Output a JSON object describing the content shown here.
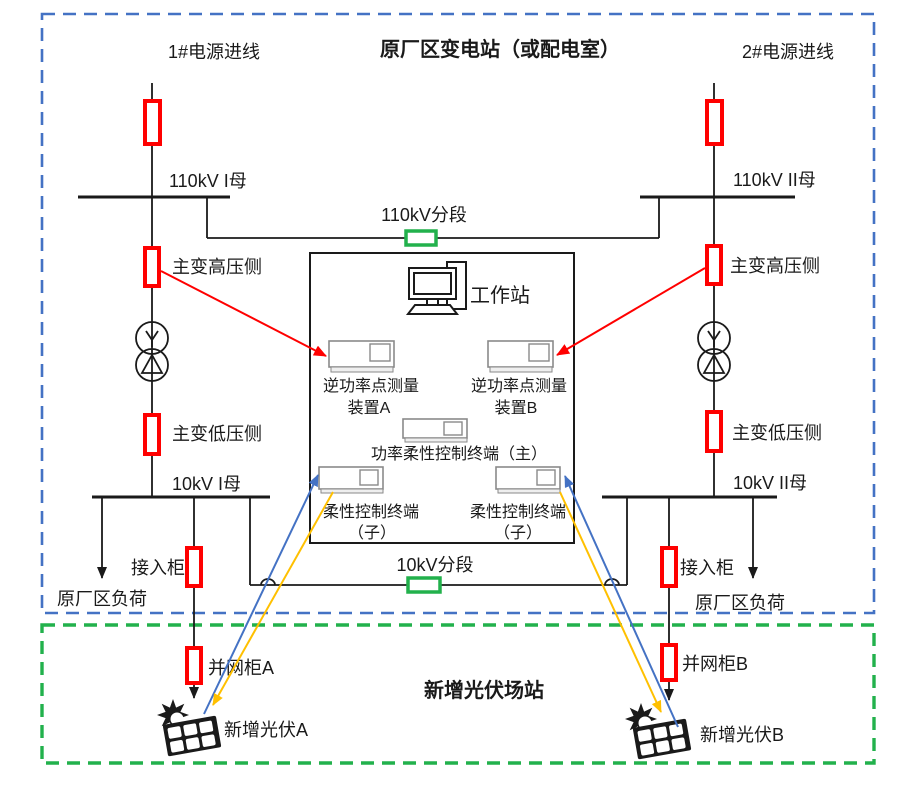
{
  "regions": {
    "substation_title": "原厂区变电站（或配电室）",
    "pv_station_title": "新增光伏场站"
  },
  "sections": {
    "s110": "110kV分段",
    "s10": "10kV分段"
  },
  "left_feeder": {
    "incoming": "1#电源进线",
    "bus_110": "110kV I母",
    "hv_side": "主变高压侧",
    "lv_side": "主变低压侧",
    "bus_10": "10kV I母",
    "access_cabinet": "接入柜",
    "load": "原厂区负荷",
    "grid_cabinet": "并网柜A",
    "pv": "新增光伏A"
  },
  "right_feeder": {
    "incoming": "2#电源进线",
    "bus_110": "110kV II母",
    "hv_side": "主变高压侧",
    "lv_side": "主变低压侧",
    "bus_10": "10kV II母",
    "access_cabinet": "接入柜",
    "load": "原厂区负荷",
    "grid_cabinet": "并网柜B",
    "pv": "新增光伏B"
  },
  "control_box": {
    "workstation": "工作站",
    "meter_a_line1": "逆功率点测量",
    "meter_a_line2": "装置A",
    "meter_b_line1": "逆功率点测量",
    "meter_b_line2": "装置B",
    "master_terminal": "功率柔性控制终端（主）",
    "child_left_line1": "柔性控制终端",
    "child_left_line2": "（子）",
    "child_right_line1": "柔性控制终端",
    "child_right_line2": "（子）"
  },
  "icons": {
    "workstation": "desktop-computer-icon",
    "device": "control-unit-icon",
    "transformer": "two-winding-wye-delta-transformer-icon",
    "pv": "solar-panel-with-sun-icon",
    "breaker": "breaker-rect-icon"
  },
  "colors": {
    "boundary_blue": "#4472C4",
    "boundary_green": "#22B14C",
    "breaker_red": "#FF0000",
    "section_green": "#22B14C",
    "arrow_red": "#FF0000",
    "arrow_blue": "#4472C4",
    "arrow_orange": "#FFC000",
    "ink_black": "#1A1A1A"
  }
}
